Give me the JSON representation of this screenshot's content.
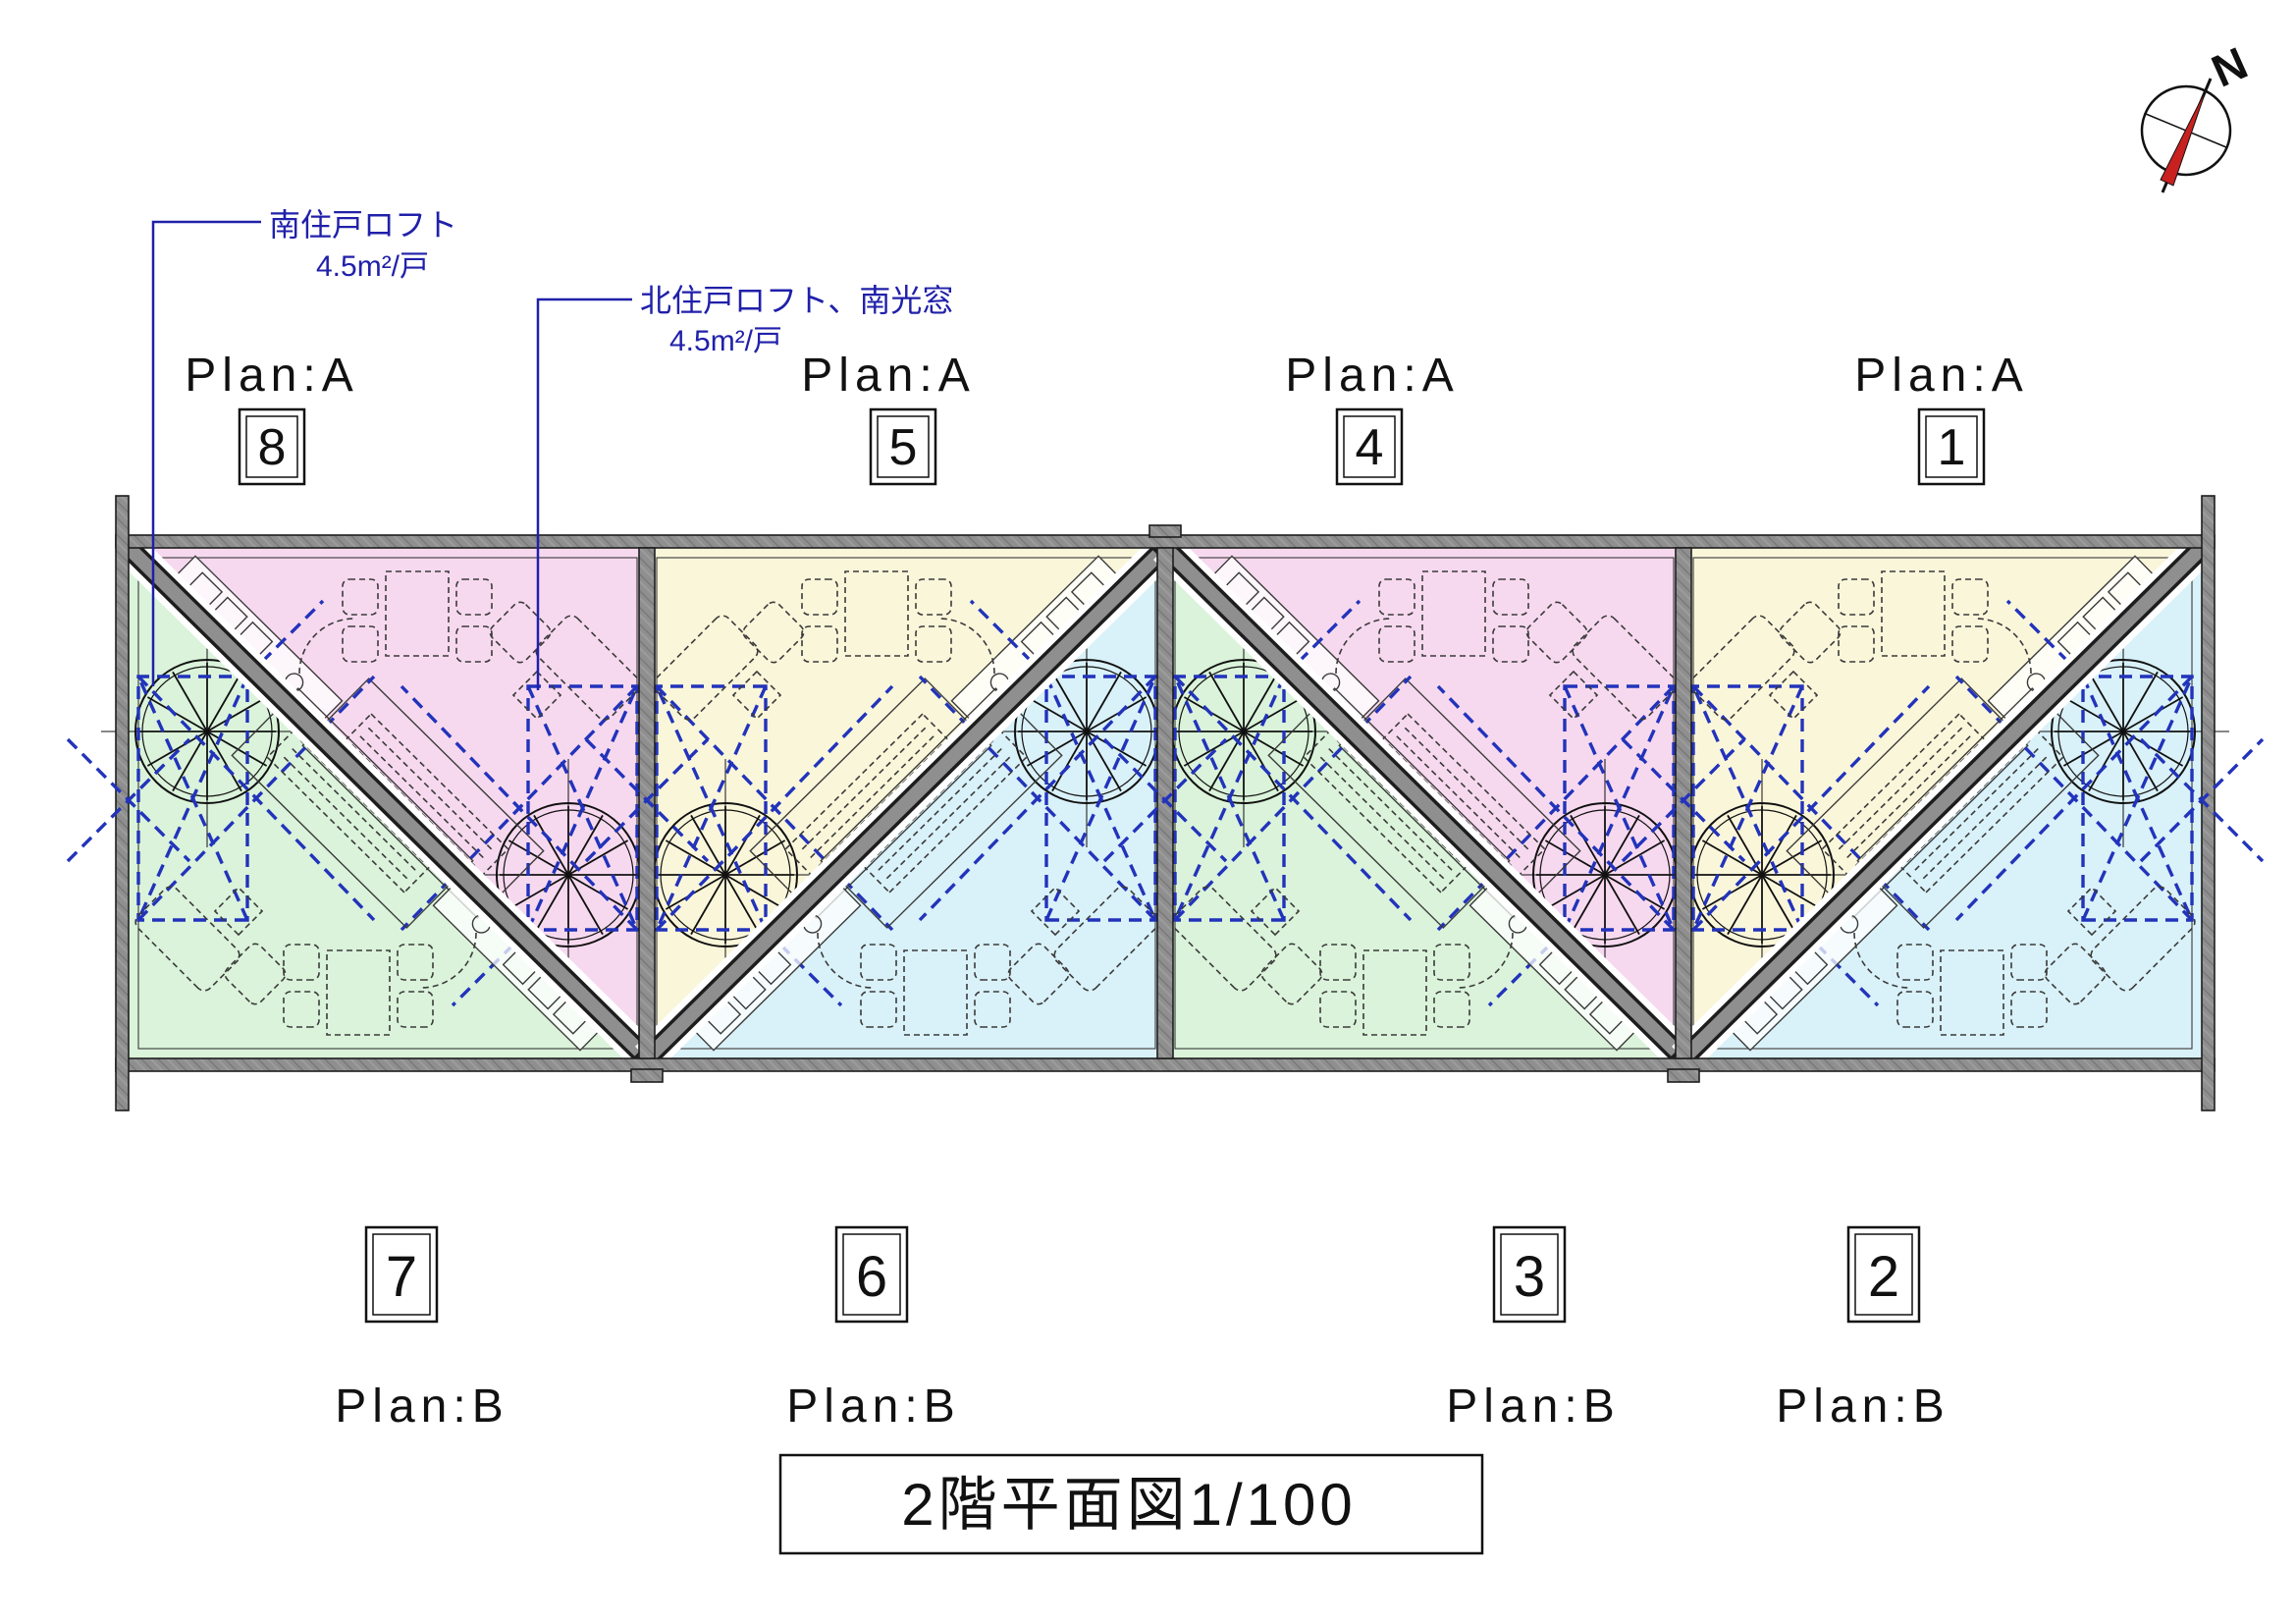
{
  "title": "2階平面図1/100",
  "compass": {
    "north_label": "N"
  },
  "annotations": {
    "south_loft": {
      "line1": "南住戸ロフト",
      "line2": "4.5m²/戸"
    },
    "north_loft": {
      "line1": "北住戸ロフト、南光窓",
      "line2": "4.5m²/戸"
    }
  },
  "top_units": [
    {
      "plan": "Plan:A",
      "number": "8"
    },
    {
      "plan": "Plan:A",
      "number": "5"
    },
    {
      "plan": "Plan:A",
      "number": "4"
    },
    {
      "plan": "Plan:A",
      "number": "1"
    }
  ],
  "bottom_units": [
    {
      "number": "7",
      "plan": "Plan:B"
    },
    {
      "number": "6",
      "plan": "Plan:B"
    },
    {
      "number": "3",
      "plan": "Plan:B"
    },
    {
      "number": "2",
      "plan": "Plan:B"
    }
  ],
  "colors": {
    "unit_pink": "#f7d9ef",
    "unit_green": "#daf3da",
    "unit_yellow": "#faf6da",
    "unit_cyan": "#d9f1f8",
    "wall_gray": "#8f8f8f",
    "wall_edge": "#1d1d1d",
    "furniture_line": "#3a3a3a",
    "loft_blue": "#2233bb",
    "leader_blue": "#2020aa",
    "needle_red": "#c92020"
  }
}
